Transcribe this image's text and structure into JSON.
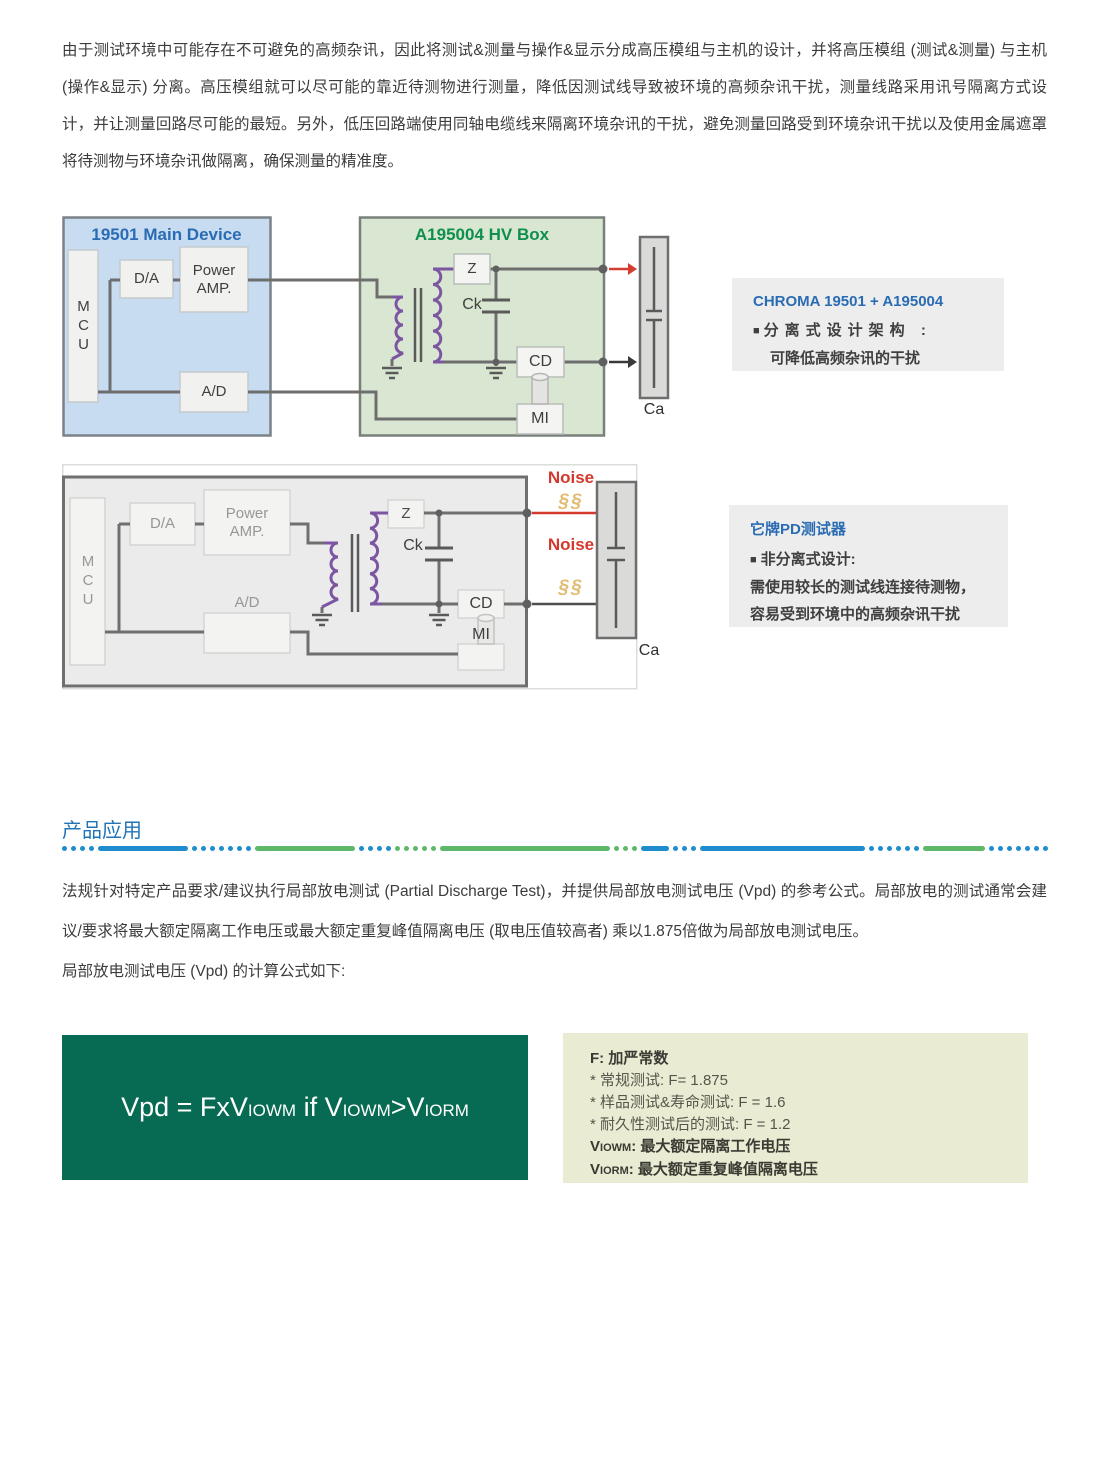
{
  "page": {
    "intro": "由于测试环境中可能存在不可避免的高频杂讯，因此将测试&测量与操作&显示分成高压模组与主机的设计，并将高压模组 (测试&测量) 与主机 (操作&显示) 分离。高压模组就可以尽可能的靠近待测物进行测量，降低因测试线导致被环境的高频杂讯干扰，测量线路采用讯号隔离方式设计，并让测量回路尽可能的最短。另外，低压回路端使用同轴电缆线来隔离环境杂讯的干扰，避免测量回路受到环境杂讯干扰以及使用金属遮罩将待测物与环境杂讯做隔离，确保测量的精准度。",
    "section_title": "产品应用",
    "body_p1": "法规针对特定产品要求/建议执行局部放电测试 (Partial Discharge Test)，并提供局部放电测试电压 (Vpd) 的参考公式。局部放电的测试通常会建议/要求将最大额定隔离工作电压或最大额定重复峰值隔离电压 (取电压值较高者) 乘以1.875倍做为局部放电测试电压。",
    "body_p2": "局部放电测试电压 (Vpd) 的计算公式如下:"
  },
  "diagram1": {
    "main_title": "19501 Main Device",
    "hv_title": "A195004 HV Box",
    "mcu": "MCU",
    "da": "D/A",
    "power_amp": "Power AMP.",
    "ad": "A/D",
    "z": "Z",
    "ck": "Ck",
    "cd": "CD",
    "mi": "MI",
    "ca": "Ca"
  },
  "note1": {
    "title": "CHROMA 19501 + A195004",
    "bullet": "■",
    "line1": "分离式设计架构 :",
    "line2": "可降低高频杂讯的干扰"
  },
  "diagram2": {
    "mcu": "MCU",
    "da": "D/A",
    "power_amp": "Power AMP.",
    "ad": "A/D",
    "z": "Z",
    "ck": "Ck",
    "cd": "CD",
    "mi": "MI",
    "ca": "Ca",
    "noise_top": "Noise",
    "noise_bottom": "Noise",
    "spark_top": "§§",
    "spark_bottom": "§§"
  },
  "note2": {
    "title": "它牌PD测试器",
    "bullet": "■",
    "line1": "非分离式设计:",
    "line2": "需使用较长的测试线连接待测物，",
    "line3": "容易受到环境中的高频杂讯干扰"
  },
  "formula": {
    "p1": "Vpd = FxV",
    "s1": "IOWM",
    "p2": " if V",
    "s2": "IOWM",
    "p3": ">V",
    "s3": "IORM"
  },
  "fbox": {
    "l1": "F: 加严常数",
    "l2": "* 常规测试: F= 1.875",
    "l3": "* 样品测试&寿命测试: F = 1.6",
    "l4": "* 耐久性测试后的测试: F = 1.2",
    "v1p": "V",
    "v1s": "IOWM",
    "v1r": ": 最大额定隔离工作电压",
    "v2p": "V",
    "v2s": "IORM",
    "v2r": ": 最大额定重复峰值隔离电压"
  },
  "colors": {
    "accent_blue": "#2a6cb4",
    "accent_green": "#0f8f4d",
    "noise_red": "#d4392e",
    "formula_green": "#076a52",
    "divider_blue": "#1e8ccd",
    "divider_green": "#5fb86a"
  }
}
